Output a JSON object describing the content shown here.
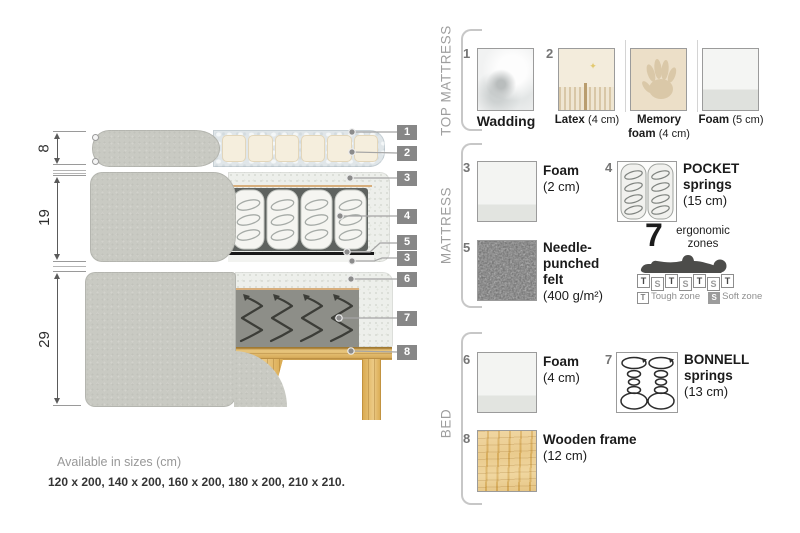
{
  "cross_section": {
    "heights_cm": [
      "8",
      "19",
      "29"
    ],
    "callouts": [
      "1",
      "2",
      "3",
      "4",
      "5",
      "3",
      "6",
      "7",
      "8"
    ]
  },
  "legend": {
    "top_mattress": {
      "title": "TOP MATTRESS",
      "wadding": {
        "num": "1",
        "name": "Wadding"
      },
      "latex": {
        "num": "2",
        "name": "Latex",
        "size": "(4 cm)"
      },
      "memory_foam": {
        "name1": "Memory",
        "name2": "foam",
        "size": "(4 cm)"
      },
      "foam": {
        "name": "Foam",
        "size": "(5 cm)"
      }
    },
    "mattress": {
      "title": "MATTRESS",
      "foam": {
        "num": "3",
        "name": "Foam",
        "size": "(2 cm)"
      },
      "pocket": {
        "num": "4",
        "name1": "POCKET",
        "name2": "springs",
        "size": "(15 cm)"
      },
      "felt": {
        "num": "5",
        "name1": "Needle-",
        "name2": "punched",
        "name3": "felt",
        "size": "(400 g/m²)"
      },
      "zones": {
        "count": "7",
        "label1": "ergonomic",
        "label2": "zones",
        "letters": [
          "T",
          "S",
          "T",
          "S",
          "T",
          "S",
          "T"
        ],
        "tough_key": "T",
        "tough_label": "Tough zone",
        "soft_key": "S",
        "soft_label": "Soft zone"
      }
    },
    "bed": {
      "title": "BED",
      "foam": {
        "num": "6",
        "name": "Foam",
        "size": "(4 cm)"
      },
      "bonnell": {
        "num": "7",
        "name1": "BONNELL",
        "name2": "springs",
        "size": "(13 cm)"
      },
      "frame": {
        "num": "8",
        "name": "Wooden frame",
        "size": "(12 cm)"
      }
    }
  },
  "footer": {
    "title": "Available in sizes (cm)",
    "sizes": "120 x 200, 140 x 200, 160 x 200, 180 x 200, 210 x 210."
  },
  "colors": {
    "fabric_gray": "#c9cac3",
    "wadding_blue_gray": "#e0e6e9",
    "latex_cream": "#f5eedd",
    "wood": "#e2b967",
    "felt_black": "#1a1a1a",
    "callout_gray": "#878787"
  }
}
